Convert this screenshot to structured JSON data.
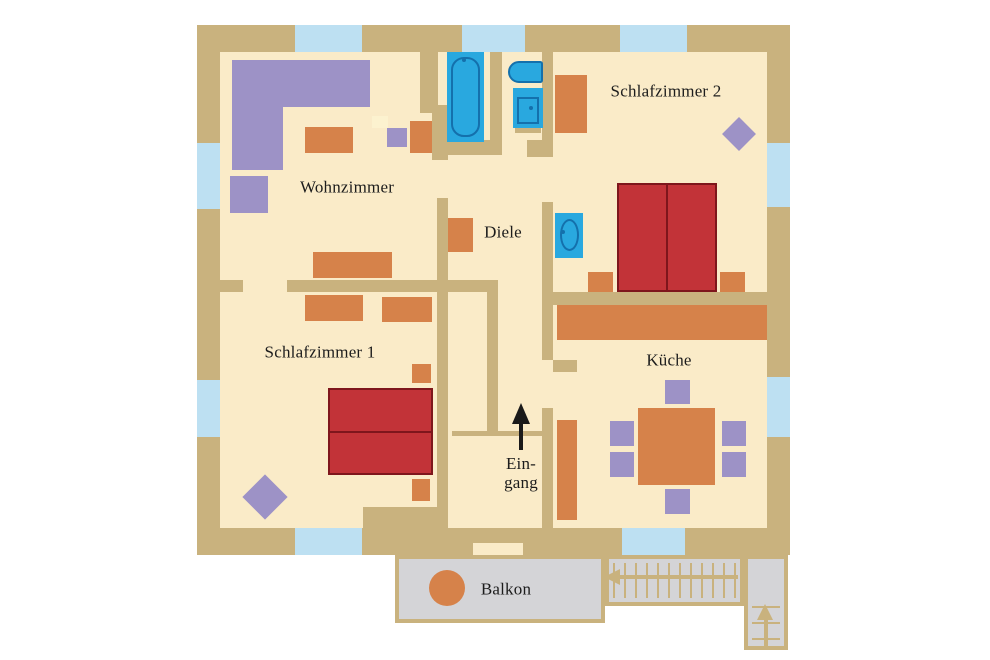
{
  "plan": {
    "canvas": {
      "width": 990,
      "height": 660
    },
    "colors": {
      "background": "#ffffff",
      "floor": "#FAEBC8",
      "wall": "#C9B27E",
      "window": "#BDE0F2",
      "furniture_orange": "#D6824A",
      "furniture_purple": "#9D92C6",
      "furniture_pale": "#FCF2CF",
      "bed_fill": "#C23338",
      "bed_border": "#7E161C",
      "fixture_blue": "#29A8DF",
      "fixture_line": "#1470AC",
      "balcony_gray": "#D4D4D7",
      "arrow_black": "#1A1A1A",
      "text": "#1C1C1C"
    },
    "labels": [
      {
        "id": "wohnzimmer",
        "text": "Wohnzimmer",
        "cx": 347,
        "cy": 187
      },
      {
        "id": "schlafzimmer2",
        "text": "Schlafzimmer 2",
        "cx": 666,
        "cy": 91
      },
      {
        "id": "diele",
        "text": "Diele",
        "cx": 503,
        "cy": 232
      },
      {
        "id": "schlafzimmer1",
        "text": "Schlafzimmer 1",
        "cx": 320,
        "cy": 352
      },
      {
        "id": "kueche",
        "text": "Küche",
        "cx": 669,
        "cy": 360
      },
      {
        "id": "eingang",
        "text": "Ein-\ngang",
        "cx": 521,
        "cy": 473
      },
      {
        "id": "balkon",
        "text": "Balkon",
        "cx": 506,
        "cy": 589
      }
    ],
    "geometry": {
      "base": {
        "name": "plan-outer-walls",
        "x": 197,
        "y": 25,
        "w": 593,
        "h": 530
      },
      "floor": {
        "name": "apartment-floor",
        "x": 220,
        "y": 52,
        "w": 547,
        "h": 476
      },
      "windows": [
        {
          "name": "window-top-1",
          "x": 295,
          "y": 25,
          "w": 67,
          "h": 27
        },
        {
          "name": "window-top-2",
          "x": 462,
          "y": 25,
          "w": 63,
          "h": 27
        },
        {
          "name": "window-top-3",
          "x": 620,
          "y": 25,
          "w": 67,
          "h": 27
        },
        {
          "name": "window-left-1",
          "x": 197,
          "y": 143,
          "w": 23,
          "h": 66
        },
        {
          "name": "window-left-2",
          "x": 197,
          "y": 380,
          "w": 23,
          "h": 57
        },
        {
          "name": "window-right-1",
          "x": 767,
          "y": 143,
          "w": 23,
          "h": 64
        },
        {
          "name": "window-right-2",
          "x": 767,
          "y": 377,
          "w": 23,
          "h": 60
        },
        {
          "name": "window-bottom-1",
          "x": 295,
          "y": 528,
          "w": 67,
          "h": 27
        },
        {
          "name": "window-bottom-2",
          "x": 622,
          "y": 528,
          "w": 63,
          "h": 27
        }
      ],
      "door_gaps": [
        {
          "name": "door-eingang-balkon",
          "x": 473,
          "y": 543,
          "w": 50,
          "h": 12
        }
      ],
      "walls": [
        {
          "name": "wall-bad-left-upper",
          "x": 420,
          "y": 52,
          "w": 18,
          "h": 61
        },
        {
          "name": "wall-bad-left-lower",
          "x": 432,
          "y": 105,
          "w": 16,
          "h": 55
        },
        {
          "name": "wall-bad-bottom",
          "x": 443,
          "y": 140,
          "w": 59,
          "h": 15
        },
        {
          "name": "wall-bad-wc-divider",
          "x": 490,
          "y": 52,
          "w": 12,
          "h": 92
        },
        {
          "name": "wall-wc-bottom-stub",
          "x": 527,
          "y": 140,
          "w": 26,
          "h": 17
        },
        {
          "name": "wall-wc-right",
          "x": 542,
          "y": 52,
          "w": 11,
          "h": 105
        },
        {
          "name": "wall-diele-sz2",
          "x": 542,
          "y": 202,
          "w": 11,
          "h": 158
        },
        {
          "name": "wall-diele-kueche",
          "x": 542,
          "y": 408,
          "w": 11,
          "h": 122
        },
        {
          "name": "wall-sz2-kueche",
          "x": 542,
          "y": 292,
          "w": 225,
          "h": 13
        },
        {
          "name": "wall-wz-sz1-stub",
          "x": 218,
          "y": 280,
          "w": 25,
          "h": 12
        },
        {
          "name": "wall-wz-sz1",
          "x": 287,
          "y": 280,
          "w": 211,
          "h": 12
        },
        {
          "name": "wall-central",
          "x": 437,
          "y": 198,
          "w": 11,
          "h": 332
        },
        {
          "name": "wall-eingang-inner",
          "x": 487,
          "y": 292,
          "w": 11,
          "h": 141
        },
        {
          "name": "wall-eingang-threshold",
          "x": 452,
          "y": 431,
          "w": 91,
          "h": 5
        },
        {
          "name": "wall-kueche-stub",
          "x": 553,
          "y": 360,
          "w": 24,
          "h": 12
        },
        {
          "name": "wall-eingang-left-mass",
          "x": 363,
          "y": 507,
          "w": 74,
          "h": 23
        },
        {
          "name": "wall-basin-base",
          "x": 515,
          "y": 123,
          "w": 26,
          "h": 10
        }
      ],
      "furniture_orange": [
        {
          "name": "wz-coffee-table",
          "x": 305,
          "y": 127,
          "w": 48,
          "h": 26
        },
        {
          "name": "wz-cabinet",
          "x": 410,
          "y": 121,
          "w": 22,
          "h": 32
        },
        {
          "name": "wz-sideboard",
          "x": 313,
          "y": 252,
          "w": 79,
          "h": 26
        },
        {
          "name": "sz1-wardrobe-left",
          "x": 305,
          "y": 295,
          "w": 58,
          "h": 26
        },
        {
          "name": "sz1-wardrobe-right",
          "x": 382,
          "y": 297,
          "w": 50,
          "h": 25
        },
        {
          "name": "sz1-nightstand-top",
          "x": 412,
          "y": 364,
          "w": 19,
          "h": 19
        },
        {
          "name": "sz1-nightstand-bottom",
          "x": 412,
          "y": 479,
          "w": 18,
          "h": 22
        },
        {
          "name": "diele-cabinet",
          "x": 448,
          "y": 218,
          "w": 25,
          "h": 34
        },
        {
          "name": "sz2-wardrobe",
          "x": 555,
          "y": 75,
          "w": 32,
          "h": 58
        },
        {
          "name": "sz2-nightstand-left",
          "x": 588,
          "y": 272,
          "w": 25,
          "h": 20
        },
        {
          "name": "sz2-nightstand-right",
          "x": 720,
          "y": 272,
          "w": 25,
          "h": 20
        },
        {
          "name": "kueche-counter",
          "x": 557,
          "y": 305,
          "w": 210,
          "h": 35
        },
        {
          "name": "kueche-shelf",
          "x": 557,
          "y": 420,
          "w": 20,
          "h": 100
        },
        {
          "name": "kueche-table",
          "x": 638,
          "y": 408,
          "w": 77,
          "h": 77
        }
      ],
      "furniture_purple": [
        {
          "name": "wz-sofa-top",
          "x": 232,
          "y": 60,
          "w": 138,
          "h": 47
        },
        {
          "name": "wz-sofa-left",
          "x": 232,
          "y": 107,
          "w": 51,
          "h": 63
        },
        {
          "name": "wz-armchair",
          "x": 230,
          "y": 176,
          "w": 38,
          "h": 37
        },
        {
          "name": "wz-tv-board",
          "x": 387,
          "y": 128,
          "w": 20,
          "h": 19
        },
        {
          "name": "kueche-chair-top",
          "x": 665,
          "y": 380,
          "w": 25,
          "h": 24
        },
        {
          "name": "kueche-chair-left-1",
          "x": 610,
          "y": 421,
          "w": 24,
          "h": 25
        },
        {
          "name": "kueche-chair-left-2",
          "x": 610,
          "y": 452,
          "w": 24,
          "h": 25
        },
        {
          "name": "kueche-chair-right-1",
          "x": 722,
          "y": 421,
          "w": 24,
          "h": 25
        },
        {
          "name": "kueche-chair-right-2",
          "x": 722,
          "y": 452,
          "w": 24,
          "h": 25
        },
        {
          "name": "kueche-chair-bottom",
          "x": 665,
          "y": 489,
          "w": 25,
          "h": 25
        }
      ],
      "furniture_pale": [
        {
          "name": "wz-side-table",
          "x": 372,
          "y": 116,
          "w": 16,
          "h": 12
        }
      ],
      "diamonds": [
        {
          "name": "plant-sz2",
          "cx": 739,
          "cy": 134,
          "size": 24
        },
        {
          "name": "plant-sz1",
          "cx": 265,
          "cy": 497,
          "size": 32
        },
        {
          "name": "balkon-chair-1",
          "cx": 415,
          "cy": 572,
          "size": 17
        },
        {
          "name": "balkon-chair-2",
          "cx": 415,
          "cy": 606,
          "size": 17
        }
      ],
      "beds": [
        {
          "name": "sz2-double-bed",
          "x": 617,
          "y": 183,
          "w": 100,
          "h": 109,
          "divider": "v"
        },
        {
          "name": "sz1-double-bed",
          "x": 328,
          "y": 388,
          "w": 105,
          "h": 87,
          "divider": "h"
        }
      ],
      "fixtures": [
        {
          "name": "bathtub",
          "kind": "tub",
          "x": 447,
          "y": 52,
          "w": 37,
          "h": 90
        },
        {
          "name": "toilet",
          "kind": "toilet",
          "x": 508,
          "y": 61,
          "w": 35,
          "h": 22
        },
        {
          "name": "washbasin-bad",
          "kind": "basin_rect",
          "x": 513,
          "y": 88,
          "w": 30,
          "h": 40
        },
        {
          "name": "washbasin-sz2",
          "kind": "basin_oval",
          "x": 555,
          "y": 213,
          "w": 28,
          "h": 45
        }
      ],
      "entrance_arrow": {
        "head": {
          "x": 512,
          "y": 403,
          "half_w": 9,
          "h": 21
        },
        "shaft": {
          "x": 519,
          "y": 422,
          "w": 4,
          "h": 28
        }
      },
      "balcony": {
        "body": {
          "name": "balcony-deck",
          "x": 395,
          "y": 555,
          "w": 210,
          "h": 68
        },
        "stairs_h": {
          "name": "staircase-run-upper",
          "x": 605,
          "y": 555,
          "w": 139,
          "h": 51,
          "step_gap": 11
        },
        "stairs_v": {
          "name": "staircase-run-lower",
          "x": 744,
          "y": 555,
          "w": 44,
          "h": 95,
          "landing_h": 47,
          "step_gap": 16
        },
        "table": {
          "name": "balkon-table",
          "cx": 447,
          "cy": 588,
          "r": 18
        },
        "arrow_left": {
          "head": {
            "x": 604,
            "y": 569
          },
          "shaft": {
            "x": 618,
            "y": 575,
            "w": 120,
            "h": 4
          }
        },
        "arrow_up": {
          "head": {
            "x": 757,
            "y": 604
          },
          "shaft": {
            "x": 764,
            "y": 618,
            "w": 4,
            "h": 28
          }
        }
      }
    }
  }
}
